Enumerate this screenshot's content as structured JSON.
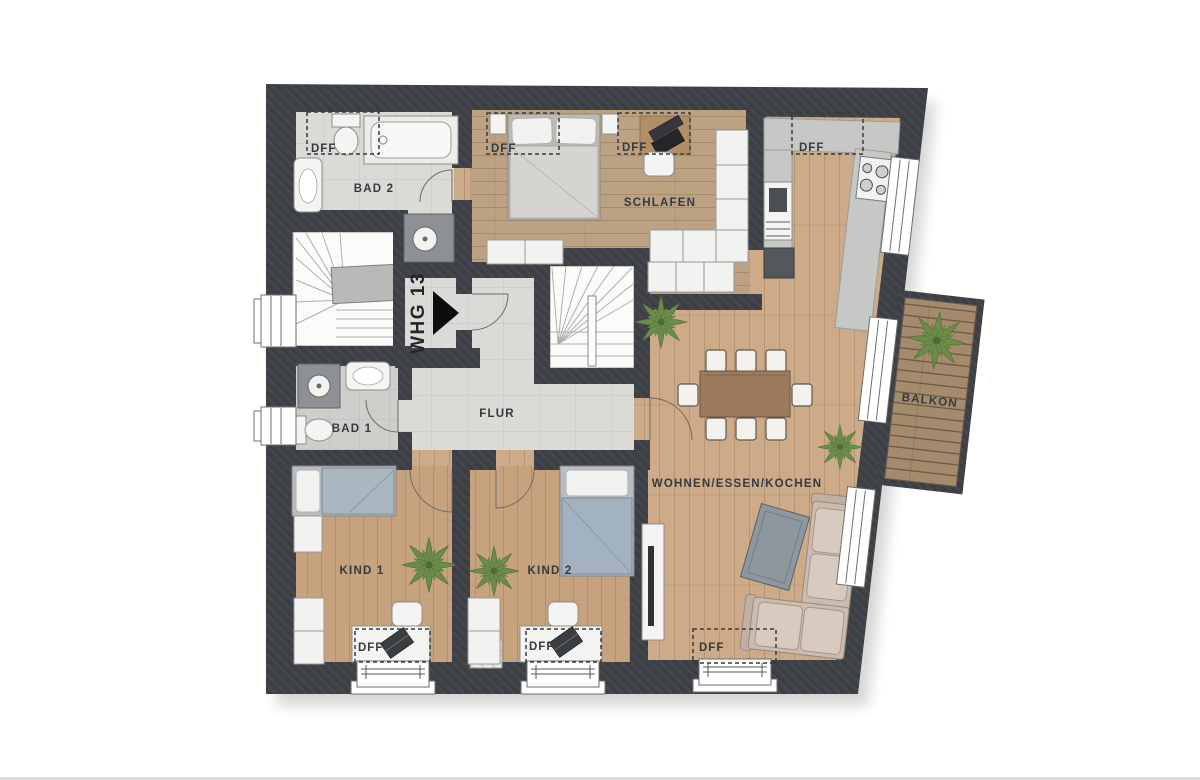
{
  "plan": {
    "unit_label": "WHG 13",
    "rooms": {
      "bad2": "BAD 2",
      "schlafen": "SCHLAFEN",
      "flur": "FLUR",
      "bad1": "BAD 1",
      "kind1": "KIND 1",
      "kind2": "KIND 2",
      "wohnen": "WOHNEN/ESSEN/KOCHEN",
      "balkon": "BALKON"
    },
    "skylight_label": "DFF",
    "skylight_count": 7
  },
  "colors": {
    "wall": "#3e4146",
    "wood_living": "#cdab88",
    "wood_schlafen": "#bda183",
    "wood_kids": "#c6a37e",
    "tile_light": "#dbdad6",
    "tile_dark": "#cfcecb",
    "balcony_wood": "#a58b6d",
    "label_text": "#343a40"
  }
}
